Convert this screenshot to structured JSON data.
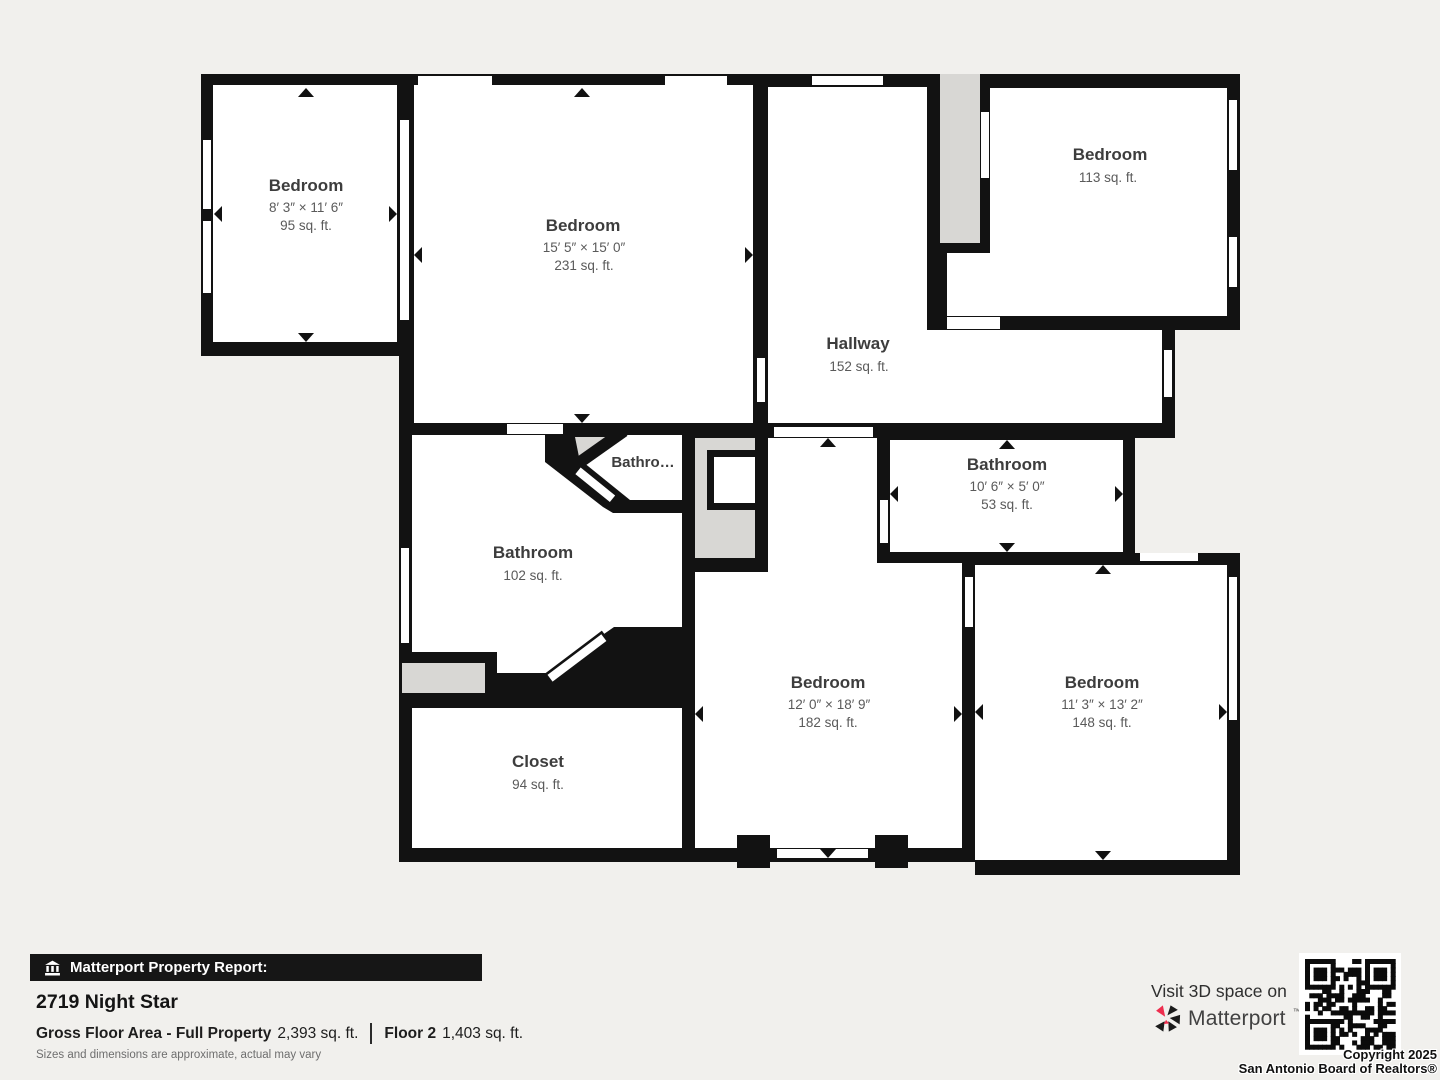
{
  "rooms": {
    "bedroom_top_left": {
      "name": "Bedroom",
      "dims": "8′ 3″ × 11′ 6″",
      "area": "95 sq. ft."
    },
    "bedroom_top_center": {
      "name": "Bedroom",
      "dims": "15′ 5″ × 15′ 0″",
      "area": "231 sq. ft."
    },
    "bedroom_top_right": {
      "name": "Bedroom",
      "area": "113 sq. ft."
    },
    "hallway": {
      "name": "Hallway",
      "area": "152 sq. ft."
    },
    "bathroom_small": {
      "name": "Bathro…"
    },
    "bathroom_left": {
      "name": "Bathroom",
      "area": "102 sq. ft."
    },
    "bathroom_right": {
      "name": "Bathroom",
      "dims": "10′ 6″ × 5′ 0″",
      "area": "53 sq. ft."
    },
    "bedroom_bottom_center": {
      "name": "Bedroom",
      "dims": "12′ 0″ × 18′ 9″",
      "area": "182 sq. ft."
    },
    "bedroom_bottom_right": {
      "name": "Bedroom",
      "dims": "11′ 3″ × 13′ 2″",
      "area": "148 sq. ft."
    },
    "closet": {
      "name": "Closet",
      "area": "94 sq. ft."
    }
  },
  "report": {
    "banner": "Matterport Property Report:",
    "address": "2719 Night Star",
    "gross_label": "Gross Floor Area - Full Property",
    "gross_value": "2,393 sq. ft.",
    "floor_label": "Floor 2",
    "floor_value": "1,403 sq. ft.",
    "disclaimer": "Sizes and dimensions are approximate, actual may vary"
  },
  "promo": {
    "visit": "Visit 3D space on",
    "brand": "Matterport",
    "brand_mark": "™",
    "copyright_line1": "Copyright 2025",
    "copyright_line2": "San Antonio Board of Realtors®"
  },
  "colors": {
    "wall": "#121212",
    "background": "#f1f0ed",
    "gray_area": "#d8d7d4",
    "accent_red": "#ee2e4e"
  }
}
